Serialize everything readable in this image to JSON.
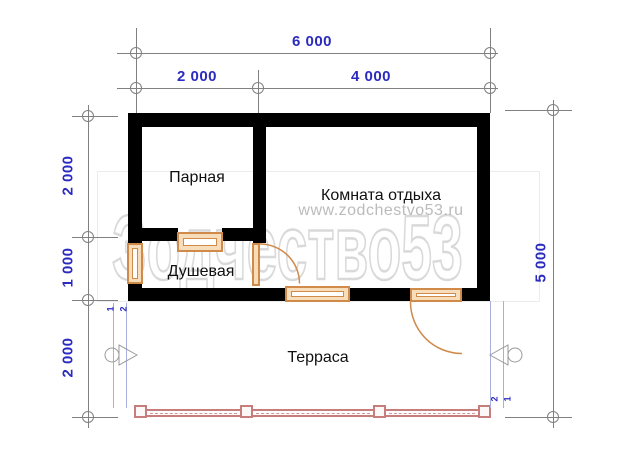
{
  "plan": {
    "rooms": {
      "steam_room": "Парная",
      "rest_room": "Комната отдыха",
      "shower": "Душевая",
      "terrace": "Терраса"
    },
    "dimensions": {
      "top_total": "6 000",
      "top_left": "2 000",
      "top_right": "4 000",
      "left_top": "2 000",
      "left_middle": "1 000",
      "left_bottom": "2 000",
      "right_total": "5 000"
    },
    "section_marks": {
      "left": [
        "1",
        "2"
      ],
      "right": [
        "2",
        "1"
      ]
    }
  },
  "watermark": {
    "url": "www.zodchestvo53.ru",
    "brand": "Зодчество53"
  },
  "colors": {
    "dim_text": "#2b2bc0",
    "axis": "#808080",
    "wall": "#000000",
    "joinery": "#d08a4a",
    "joinery_fill": "#f7ddba",
    "railing": "#c87d7d",
    "section": "#a8aede"
  }
}
